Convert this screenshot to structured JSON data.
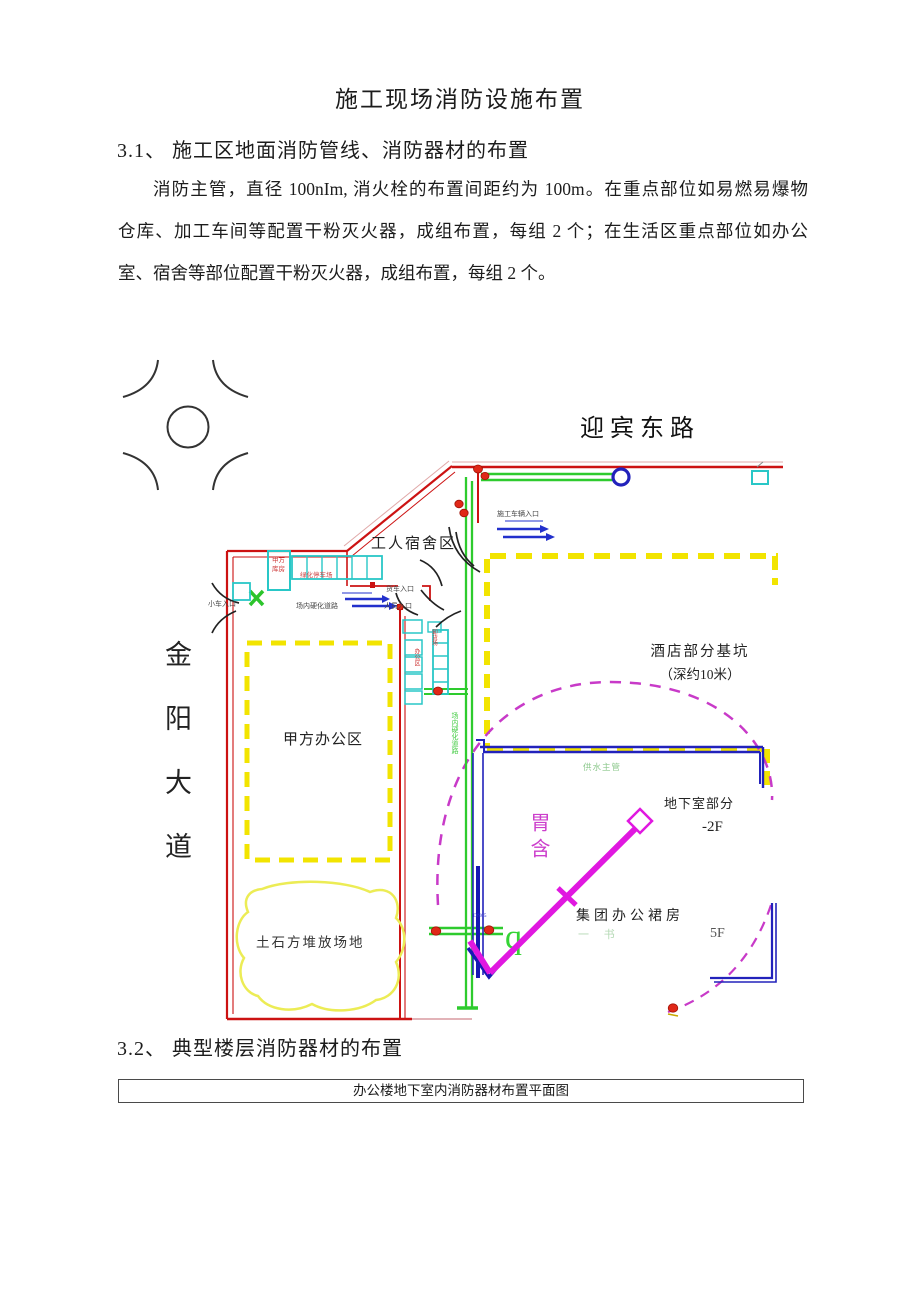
{
  "doc": {
    "title": "施工现场消防设施布置",
    "section_31_heading": "3.1、 施工区地面消防管线、消防器材的布置",
    "para_lines": [
      "消防主管，直径 100nIm, 消火栓的布置间距约为 100m。在重点部位如易燃易爆物",
      "仓库、加工车间等配置干粉灭火器，成组布置，每组 2 个；在生活区重点部位如办公",
      "室、宿舍等部位配置干粉灭火器，成组布置，每组 2 个。"
    ],
    "section_32_heading": "3.2、 典型楼层消防器材的布置",
    "figure_caption": "办公楼地下室内消防器材布置平面图"
  },
  "plan": {
    "road_top": "迎宾东路",
    "road_left_chars": "金阳大道",
    "worker_dorm": "工人宿舍区",
    "party_a_office": "甲方办公区",
    "soil_area": "土石方堆放场地",
    "pit_line1": "酒店部分基坑",
    "pit_line2": "（深约10米）",
    "basement": "地下室部分",
    "basement_floor": "-2F",
    "podium": "集团办公裙房",
    "podium_floor": "5F",
    "podium_faint": "一  书",
    "crane_text": "胃含",
    "entrance_vehicle": "施工车辆入口",
    "entrance_truck": "货车入口",
    "entrance_person": "人员入口",
    "entrance_car": "小车入口",
    "road_hard": "场内硬化道路",
    "road_hard_vertical": "场内硬化道路",
    "warehouse_line1": "甲方",
    "warehouse_line2": "库房",
    "parking_strip": "绿化停车场",
    "office_vertical": "办公区",
    "unload_vertical": "卸货场",
    "pipe_label": "供水主管",
    "dn_label": "DN65",
    "q_mark": "q"
  },
  "colors": {
    "boundary_red": "#cc1212",
    "pipe_green": "#2ecb2e",
    "pit_yellow": "#f2e400",
    "building_cyan": "#29c7c7",
    "structure_blue": "#2222bb",
    "crane_magenta": "#e018e0",
    "swing_dashed_magenta": "#c83ac8"
  }
}
